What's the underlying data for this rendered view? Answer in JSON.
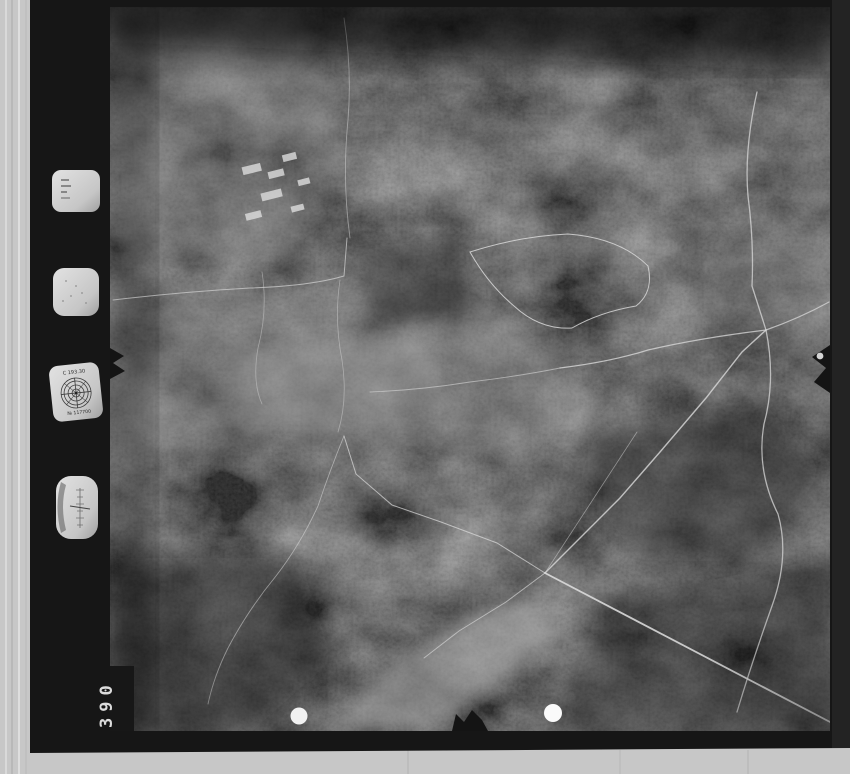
{
  "film_margin": {
    "frame_number": "390",
    "collimation_dial": {
      "arc_label": "C 193.30",
      "serial_label": "№ 117700"
    },
    "instrument_icons": [
      "data-plate-icon",
      "clock-dial-icon",
      "collimation-target-icon",
      "altimeter-dial-icon"
    ]
  },
  "marks": {
    "fiducial_left": "fiducial-notch-left-icon",
    "fiducial_right": "fiducial-notch-right-icon",
    "fiducial_bottom": "fiducial-notch-bottom-icon",
    "registration_dots": 2
  },
  "colors": {
    "mount_gray": "#c7c7c7",
    "film_black": "#161616",
    "terrain_dark": "#2b2b2b",
    "marking_white": "#ececec"
  }
}
